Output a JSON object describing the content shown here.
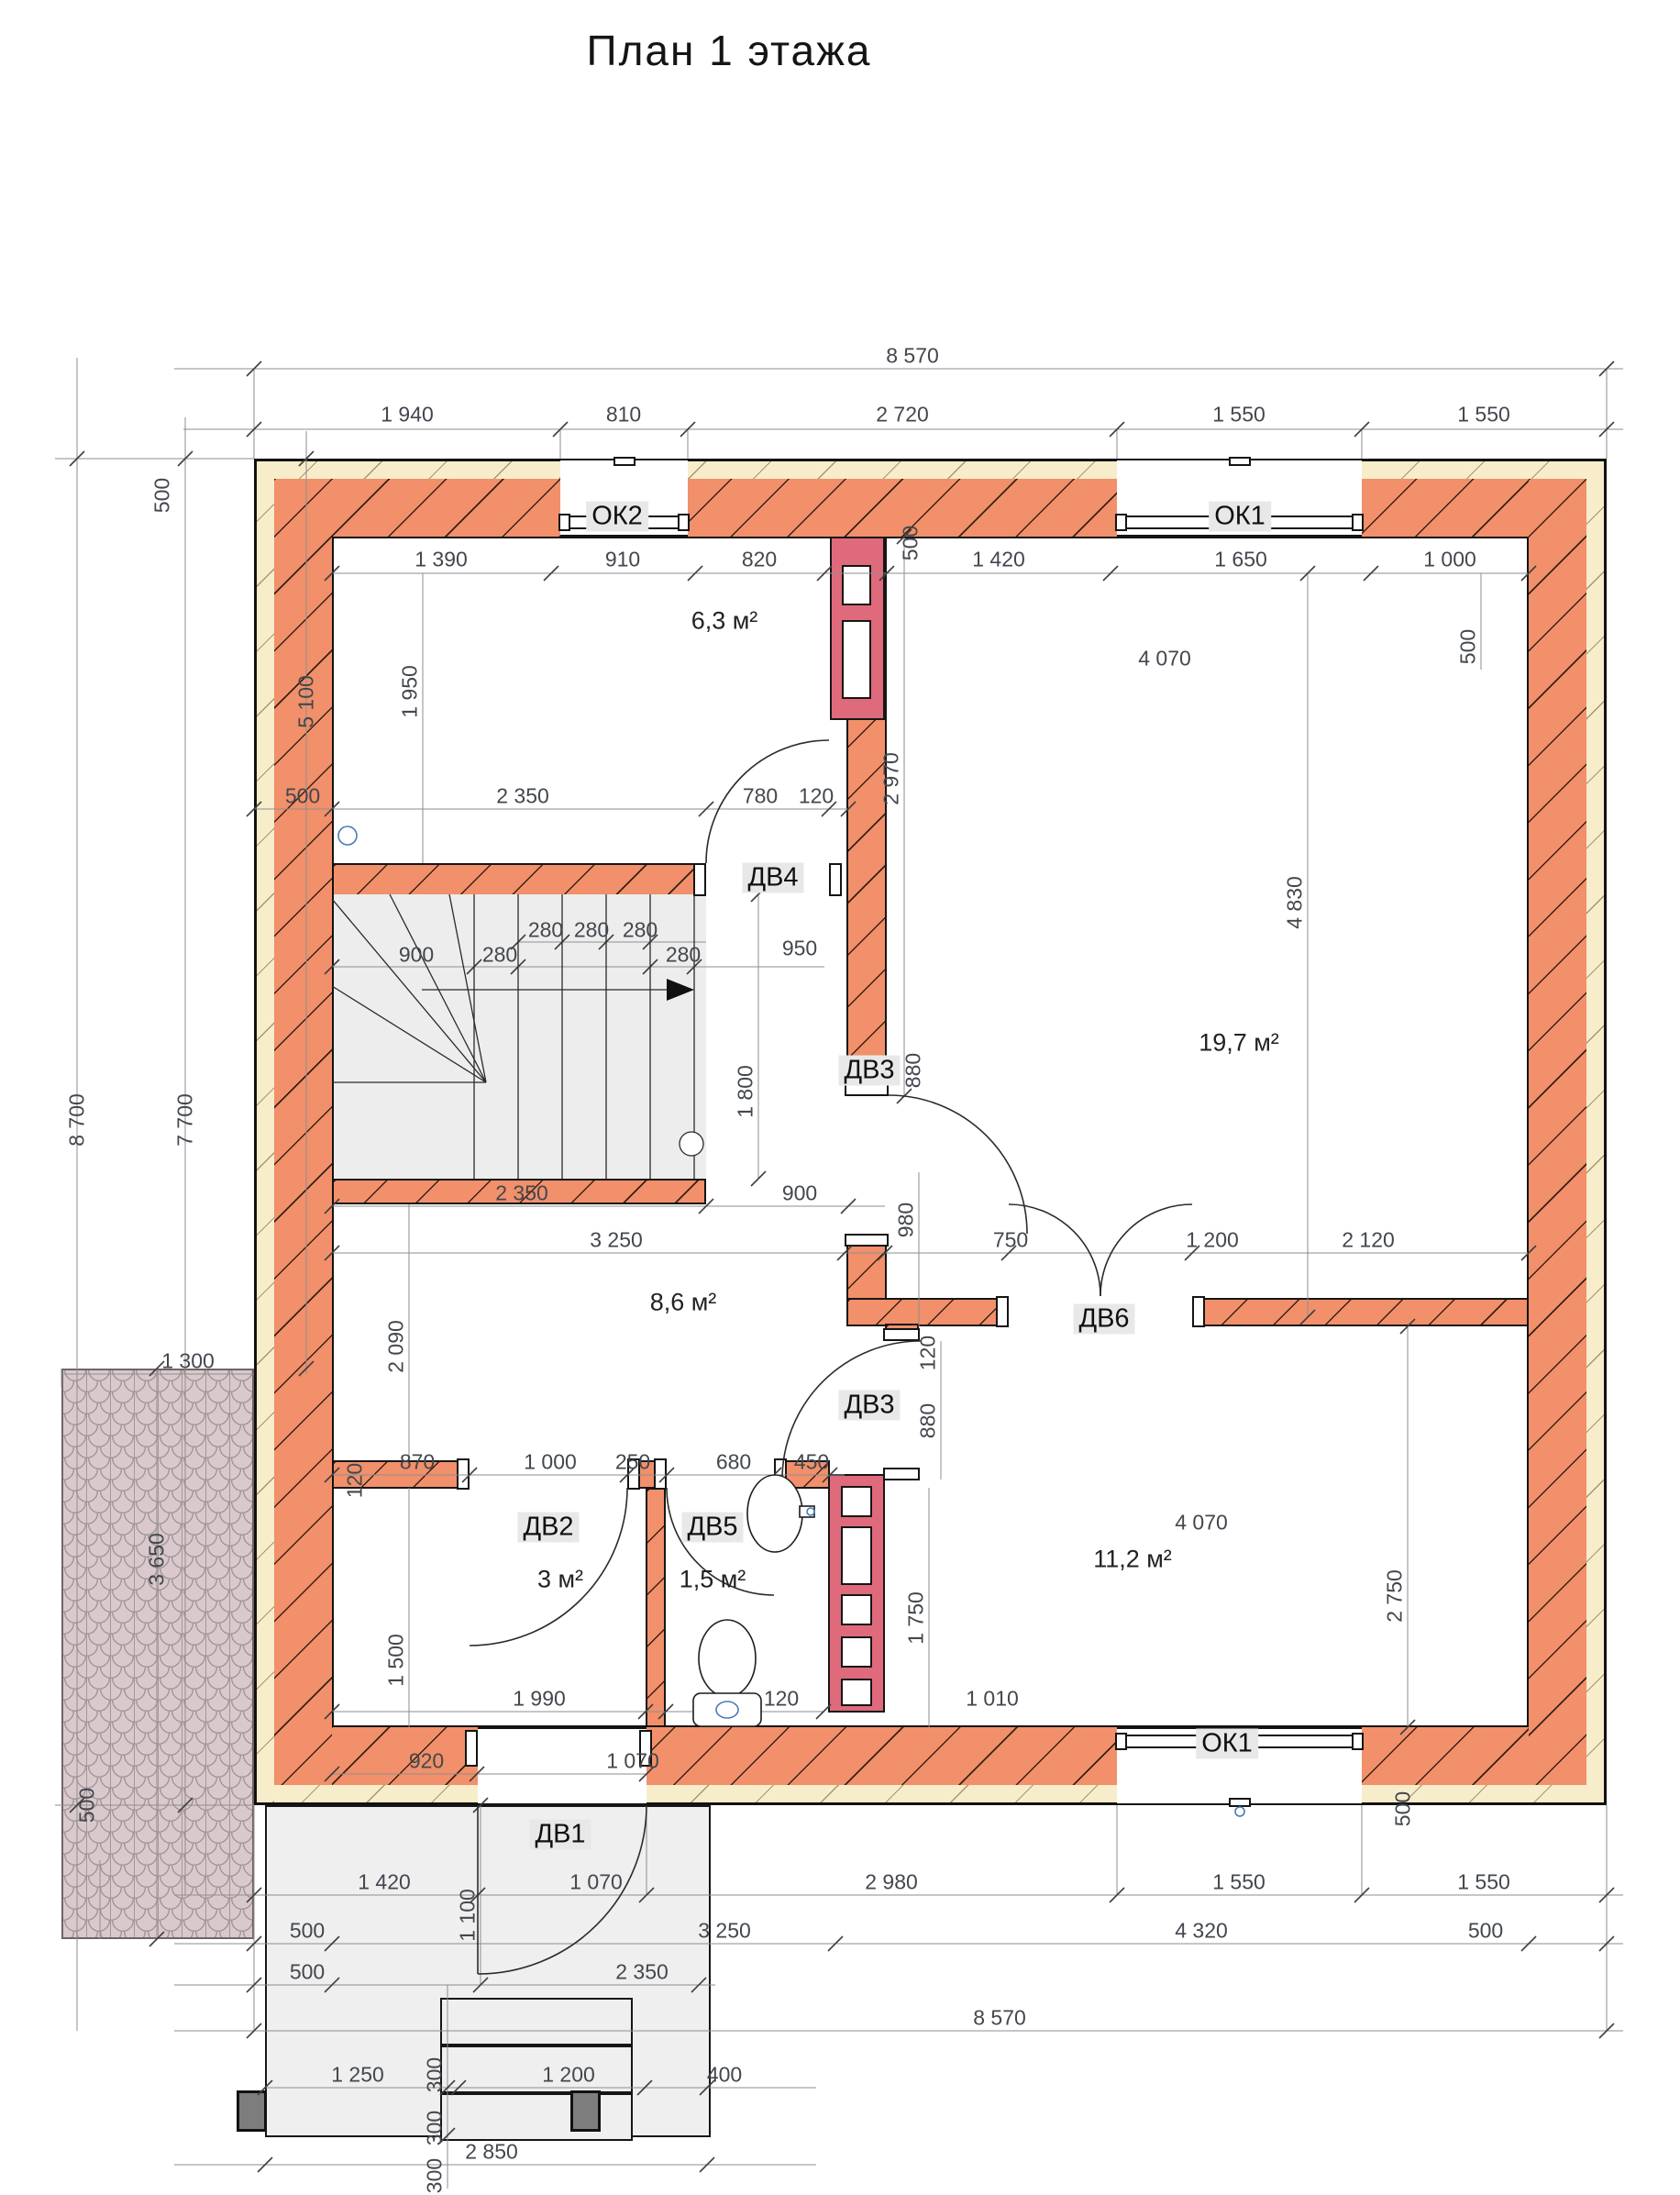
{
  "title": "План 1 этажа",
  "windows": {
    "ok2": "ОК2",
    "ok1_top": "ОК1",
    "ok1_bottom": "ОК1"
  },
  "doors": {
    "dv1": "ДВ1",
    "dv2": "ДВ2",
    "dv3_upper": "ДВ3",
    "dv3_lower": "ДВ3",
    "dv4": "ДВ4",
    "dv5": "ДВ5",
    "dv6": "ДВ6"
  },
  "rooms": {
    "top_hall": "6,3 м²",
    "living": "19,7 м²",
    "mid_hall": "8,6 м²",
    "entry": "3 м²",
    "bathroom": "1,5 м²",
    "bedroom": "11,2 м²"
  },
  "dims": {
    "top": {
      "overall": "8 570",
      "seg": [
        "1 940",
        "810",
        "2 720",
        "1 550",
        "1 550"
      ],
      "inner": [
        "1 390",
        "910",
        "820",
        "1 420",
        "1 650",
        "1 000"
      ],
      "wall_mid": "500",
      "wall_right": "500",
      "living_w": "4 070"
    },
    "left": {
      "total": "8 700",
      "inner": "7 700",
      "upper": "5 100",
      "wall_top": "500",
      "hall_h": "1 950",
      "terrace_w": "1 300",
      "terrace_h": "3 650",
      "terrace_end": "500"
    },
    "right": {
      "living_h": "4 830",
      "pass_w": "2 120",
      "bedroom_h": "2 750",
      "wall_bottom": "500"
    },
    "stairs": {
      "wall": "500",
      "width": "2 350",
      "door": "780",
      "pier": "120",
      "run": "900",
      "t1": "280",
      "t2": "280",
      "t3": "280",
      "t4": "280",
      "t5": "280",
      "to_shaft": "950",
      "well": "1 800",
      "below_w": "2 350",
      "below_run": "900",
      "shaft_h": "2 970",
      "door3_h": "880"
    },
    "mid": {
      "hall_w": "3 250",
      "hall_h": "2 090",
      "v980": "980",
      "w750": "750",
      "dv6_w": "1 200",
      "v120": "120",
      "dv3_h": "880"
    },
    "san": {
      "row": [
        "870",
        "1 000",
        "250",
        "680",
        "450"
      ],
      "v120": "120",
      "entry_h": "1 500",
      "r1990": "1 990",
      "r120": "120",
      "r1010": "1 010",
      "b920": "920",
      "b1070": "1 070",
      "wc_h": "1 750"
    },
    "bed": {
      "w": "4 070"
    },
    "bottom": {
      "row": [
        "1 420",
        "1 070",
        "2 980",
        "1 550",
        "1 550"
      ],
      "w500a": "500",
      "porch_d": "1 100",
      "w3250": "3 250",
      "w4320": "4 320",
      "w500b": "500",
      "w500c": "500",
      "w2350": "2 350",
      "overall": "8 570",
      "s1250": "1 250",
      "s300a": "300",
      "s1200": "1 200",
      "s400": "400",
      "s300b": "300",
      "s300c": "300",
      "s2850": "2 850"
    }
  }
}
